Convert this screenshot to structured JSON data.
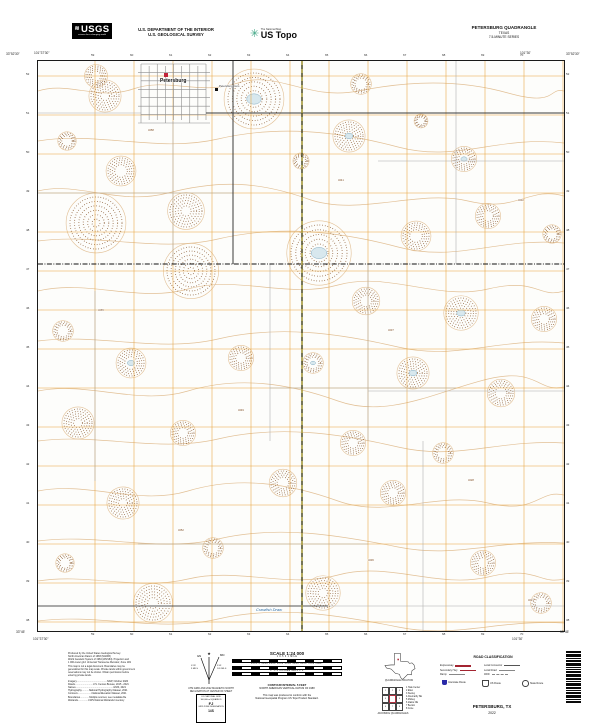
{
  "header": {
    "usgs": "USGS",
    "usgs_wave": "≋",
    "tagline": "science for a changing world",
    "dept1": "U.S. DEPARTMENT OF THE INTERIOR",
    "dept2": "U.S. GEOLOGICAL SURVEY",
    "tnm": "The National Map",
    "ustopo": "US Topo",
    "ustopo_flower": "✳",
    "quad": "PETERSBURG QUADRANGLE",
    "state": "TEXAS",
    "series": "7.5-MINUTE SERIES"
  },
  "map": {
    "town_label": "Petersburg",
    "cemetery_label": "Petersburg Cem",
    "stream_label": "Crawfish Draw",
    "corners": {
      "tl_lat": "33°52'30\"",
      "tl_lon": "101°37'30\"",
      "tr_lat": "33°52'30\"",
      "tr_lon": "101°30'",
      "bl_lat": "33°45'",
      "bl_lon": "101°37'30\"",
      "br_lat": "33°45'",
      "br_lon": "101°30'"
    },
    "grid_numbers_top": [
      "59",
      "60",
      "61",
      "62",
      "63",
      "64",
      "65",
      "66",
      "67",
      "68",
      "69",
      "70"
    ],
    "grid_numbers_bottom": [
      "59",
      "60",
      "61",
      "62",
      "63",
      "64",
      "65",
      "66",
      "67",
      "68",
      "69",
      "70"
    ],
    "grid_numbers_left": [
      "52",
      "51",
      "50",
      "49",
      "48",
      "47",
      "46",
      "45",
      "44",
      "43",
      "42",
      "41",
      "40",
      "39",
      "38"
    ],
    "grid_numbers_right": [
      "52",
      "51",
      "50",
      "49",
      "48",
      "47",
      "46",
      "45",
      "44",
      "43",
      "42",
      "41",
      "40",
      "39",
      "38"
    ]
  },
  "footer": {
    "credits": [
      "Produced by the United States Geological Survey",
      "North American Datum of 1983 (NAD83)",
      "World Geodetic System of 1984 (WGS84).  Projection and",
      "1 000-meter grid: Universal Transverse Mercator, Zone 14N",
      "This map is not a legal document. Boundaries may be",
      "generalized for this map scale. Private lands within government",
      "reservations may not be shown. Obtain permission before",
      "entering private lands.",
      "",
      "Imagery..............................................NAIP, October 2020",
      "Roads...........................U.S. Census Bureau, 2015 - 2021",
      "Names.........................................................GNIS, 2021",
      "Hydrography...........National Hydrography Dataset, 2021",
      "Contours.....................National Elevation Dataset, 2021",
      "Boundaries..............Multiple sources; see metadata file",
      "Wetlands................FWS National Wetlands Inventory"
    ],
    "decl": {
      "star": "★",
      "gn": "GN",
      "mn": "MN",
      "a1": "0°28´",
      "m1": "9 MILS",
      "a2": "5°41´",
      "m2": "101 MILS"
    },
    "decl_cap1": "UTM GRID AND 2022 MAGNETIC NORTH",
    "decl_cap2": "DECLINATION AT CENTER OF SHEET",
    "usng": [
      "U.S. NATIONAL GRID",
      "100,000-m SQUARE ID",
      "FJ",
      "GRID ZONE DESIGNATION",
      "14S"
    ],
    "scale_title": "SCALE 1:24 000",
    "bars": [
      {
        "text": "1        0.5        0                              1  MILE"
      },
      {
        "text": "1000   0   1000  2000  3000  4000  5000  6000  7000 FEET"
      },
      {
        "text": "1     .5     0          KILOMETERS          1          2"
      }
    ],
    "contour1": "CONTOUR INTERVAL 5 FEET",
    "contour2": "NORTH AMERICAN VERTICAL DATUM OF 1988",
    "conform1": "This map was produced to conform with the",
    "conform2": "National Geospatial Program US Topo Product Standard.",
    "tx_label": "QUADRANGLE LOCATION",
    "adj_cells": [
      "1",
      "2",
      "3",
      "4",
      "",
      "5",
      "6",
      "7",
      "8"
    ],
    "adj_list": [
      "1  Hale Center",
      "2  Ellen",
      "3  Sterley",
      "4  Abernathy SE",
      "5  Mickey",
      "6  Idalou NE",
      "7  Becton",
      "8  Cone"
    ],
    "adj_label": "ADJOINING QUADRANGLES",
    "rc_title": "ROAD CLASSIFICATION",
    "rc_left": [
      {
        "label": "Expressway",
        "style": "exp"
      },
      {
        "label": "Secondary Hwy",
        "style": "sec"
      },
      {
        "label": "Ramp",
        "style": "ramp"
      }
    ],
    "rc_right": [
      {
        "label": "Local Connector",
        "style": "conn"
      },
      {
        "label": "Local Road",
        "style": "local"
      },
      {
        "label": "4WD",
        "style": "fwd"
      }
    ],
    "shields": [
      {
        "type": "interstate",
        "label": "Interstate Route"
      },
      {
        "type": "us",
        "label": "US Route"
      },
      {
        "type": "state",
        "label": "State Route"
      }
    ],
    "barcode_bars": [
      2,
      3,
      1,
      2,
      3,
      1,
      1,
      2,
      3,
      2,
      1,
      3,
      2,
      1,
      2,
      3,
      1,
      2
    ],
    "map_name": "PETERSBURG, TX",
    "map_year": "2022"
  },
  "colors": {
    "contour": "#e2c096",
    "depression": "#7d4a1e",
    "grid_orange": "#e8a33d",
    "gray_line": "#ababab",
    "town_gray": "#8d8d8d",
    "road_black": "#3a3a3a",
    "highway_base": "#4a4a22",
    "highway_dash": "#e6cf3e",
    "water_fill": "#d8e8ee",
    "water_line": "#85aec4",
    "building_red": "#c1253b",
    "stream_blue": "#2b6ca3",
    "interstate_blue": "#2a2aa8",
    "legend_red": "#a32431"
  },
  "map_features": {
    "grid": {
      "x0": 57,
      "dx": 39,
      "nx": 13,
      "y0": 15,
      "dy": 39,
      "ny": 15
    },
    "contour_paths": [
      "M0,30 C30,20 60,40 95,28 S160,35 200,22 S270,40 320,30 S420,18 470,32 S510,26 526,30",
      "M0,80 C60,70 120,92 180,78 S300,70 360,86 S460,74 526,82",
      "M0,130 C40,120 80,145 130,132 S220,120 270,138 S380,128 430,140 S490,125 526,135",
      "M0,180 C60,172 120,192 180,178 S300,170 360,186 S460,176 526,182",
      "M0,230 C50,218 100,242 150,228 S250,238 300,224 S400,240 450,228 S500,238 526,230",
      "M0,280 C60,272 120,292 180,278 S300,272 360,286 S460,276 526,282",
      "M0,330 C50,320 100,345 150,330 S250,322 300,340 S400,330 450,318 S500,332 526,326",
      "M0,380 C60,372 120,392 180,378 S300,372 360,386 S460,378 526,382",
      "M0,430 C50,420 100,445 150,430 S250,422 300,440 S400,430 450,442 S500,428 526,434",
      "M0,480 C60,472 120,492 180,478 S300,474 360,486 S460,478 526,482",
      "M0,520 C50,512 100,530 150,518 S250,528 300,514 S400,528 450,516 S500,524 526,518",
      "M0,560 C60,552 120,572 180,558 S300,554 360,566 S460,558 526,562"
    ],
    "playas": [
      [
        58,
        15,
        10,
        0
      ],
      [
        67,
        35,
        14,
        0
      ],
      [
        29,
        80,
        8,
        0
      ],
      [
        216,
        38,
        26,
        1
      ],
      [
        323,
        23,
        9,
        0
      ],
      [
        311,
        75,
        14,
        1
      ],
      [
        383,
        60,
        6,
        0
      ],
      [
        426,
        98,
        11,
        1
      ],
      [
        263,
        100,
        7,
        0
      ],
      [
        83,
        110,
        13,
        0
      ],
      [
        148,
        150,
        16,
        0
      ],
      [
        58,
        162,
        26,
        0
      ],
      [
        450,
        155,
        11,
        0
      ],
      [
        514,
        173,
        8,
        0
      ],
      [
        378,
        175,
        13,
        0
      ],
      [
        281,
        192,
        28,
        1
      ],
      [
        153,
        210,
        24,
        0
      ],
      [
        328,
        240,
        12,
        0
      ],
      [
        423,
        252,
        15,
        1
      ],
      [
        506,
        258,
        11,
        0
      ],
      [
        25,
        270,
        9,
        0
      ],
      [
        93,
        302,
        13,
        1
      ],
      [
        203,
        297,
        11,
        0
      ],
      [
        275,
        302,
        9,
        1
      ],
      [
        375,
        312,
        14,
        1
      ],
      [
        463,
        332,
        12,
        0
      ],
      [
        40,
        362,
        14,
        0
      ],
      [
        145,
        372,
        11,
        0
      ],
      [
        315,
        382,
        11,
        0
      ],
      [
        405,
        392,
        9,
        0
      ],
      [
        245,
        422,
        12,
        0
      ],
      [
        85,
        442,
        14,
        0
      ],
      [
        355,
        432,
        11,
        0
      ],
      [
        27,
        502,
        8,
        0
      ],
      [
        175,
        487,
        9,
        0
      ],
      [
        285,
        532,
        15,
        0
      ],
      [
        445,
        502,
        11,
        0
      ],
      [
        115,
        542,
        17,
        0
      ],
      [
        503,
        542,
        9,
        0
      ]
    ],
    "gray_segments": [
      [
        135,
        60,
        135,
        203
      ],
      [
        57,
        230,
        57,
        420
      ],
      [
        330,
        203,
        330,
        380
      ],
      [
        418,
        0,
        418,
        203
      ],
      [
        385,
        380,
        385,
        570
      ],
      [
        232,
        203,
        232,
        380
      ],
      [
        0,
        132,
        195,
        132
      ],
      [
        232,
        327,
        418,
        327
      ],
      [
        100,
        483,
        330,
        483
      ],
      [
        340,
        100,
        526,
        100
      ],
      [
        330,
        330,
        526,
        330
      ],
      [
        0,
        52,
        103,
        52
      ],
      [
        290,
        545,
        526,
        545
      ]
    ],
    "town": {
      "x0": 103,
      "x1": 168,
      "y0": 3,
      "y1": 62,
      "nv": 9,
      "nh": 8
    },
    "roads": {
      "black_h_y": 52,
      "black_h_x1": 168,
      "black_h_x2": 526,
      "black_v_x": 195,
      "black_v_y1": 0,
      "black_v_y2": 203,
      "gray_road_y": 545,
      "gray_road_x1": 0,
      "gray_road_x2": 290,
      "highway_x": 264,
      "boundary_y": 203
    },
    "markers": {
      "building": [
        126,
        12,
        4,
        4
      ],
      "cemetery": [
        177,
        27,
        3,
        3
      ]
    },
    "label_pos": {
      "town": [
        122,
        21
      ],
      "cem": [
        181,
        26
      ],
      "stream": [
        218,
        550
      ]
    },
    "spot_elevations": [
      [
        110,
        70,
        "3258"
      ],
      [
        300,
        120,
        "3241"
      ],
      [
        480,
        140,
        "3232"
      ],
      [
        60,
        250,
        "3265"
      ],
      [
        350,
        270,
        "3237"
      ],
      [
        200,
        350,
        "3249"
      ],
      [
        430,
        420,
        "3228"
      ],
      [
        140,
        470,
        "3252"
      ],
      [
        330,
        500,
        "3236"
      ],
      [
        490,
        540,
        "3221"
      ]
    ]
  }
}
